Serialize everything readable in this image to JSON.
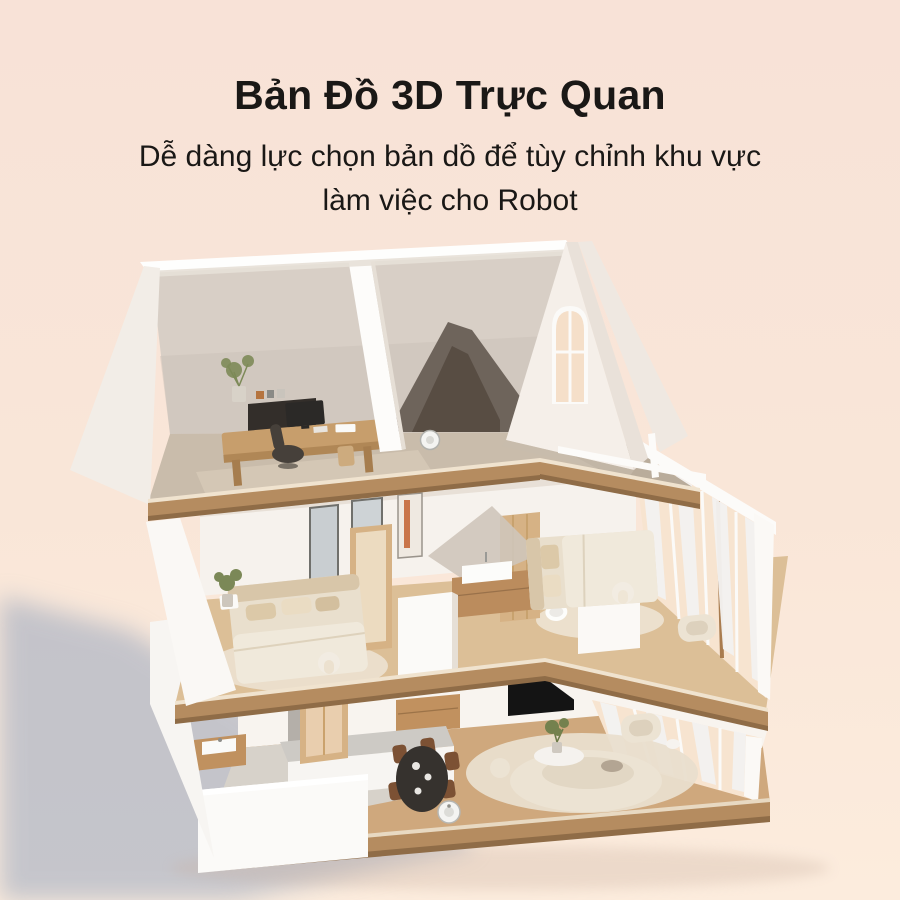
{
  "header": {
    "title": "Bản Đồ 3D Trực Quan",
    "subtitle_line1": "Dễ dàng lực chọn bản dồ để tùy chỉnh khu vực",
    "subtitle_line2": "làm việc cho Robot"
  },
  "colors": {
    "background_top": "#f8e2d7",
    "background_mid": "#f9e6d8",
    "background_bottom": "#fcecdd",
    "shadow": "#8fa0bb",
    "title_text": "#1a1816",
    "wall": "#fbf9f7",
    "wood_floor": "#cfa87d",
    "wood_trim": "#b58c60",
    "oak": "#d6b285",
    "fabric": "#e9dfcd",
    "robot": "#f4f4f2"
  },
  "scene": {
    "type": "3d-cutaway-house-render",
    "robot_vacuum_count": 2,
    "floors": [
      {
        "name": "attic-studio",
        "items": [
          "office-desk",
          "desk-chair",
          "console-shelf",
          "potted-plant",
          "stool",
          "robot-vacuum",
          "gable-arched-window",
          "balcony-rail"
        ]
      },
      {
        "name": "second-floor",
        "items": [
          "master-bed",
          "area-rug",
          "potted-plant",
          "wall-art",
          "oak-door",
          "wardrobe-panel",
          "bathroom-vanity",
          "sink",
          "toilet",
          "guest-bed",
          "armchair",
          "curtain-window-wall"
        ]
      },
      {
        "name": "ground-floor",
        "items": [
          "laundry-door",
          "utility-sink",
          "kitchen-counter",
          "stove",
          "dining-table",
          "dining-chairs",
          "sideboard",
          "tv-panel",
          "curved-sofa",
          "coffee-table",
          "armchair",
          "robot-vacuum",
          "curtain-window-wall"
        ]
      }
    ]
  }
}
